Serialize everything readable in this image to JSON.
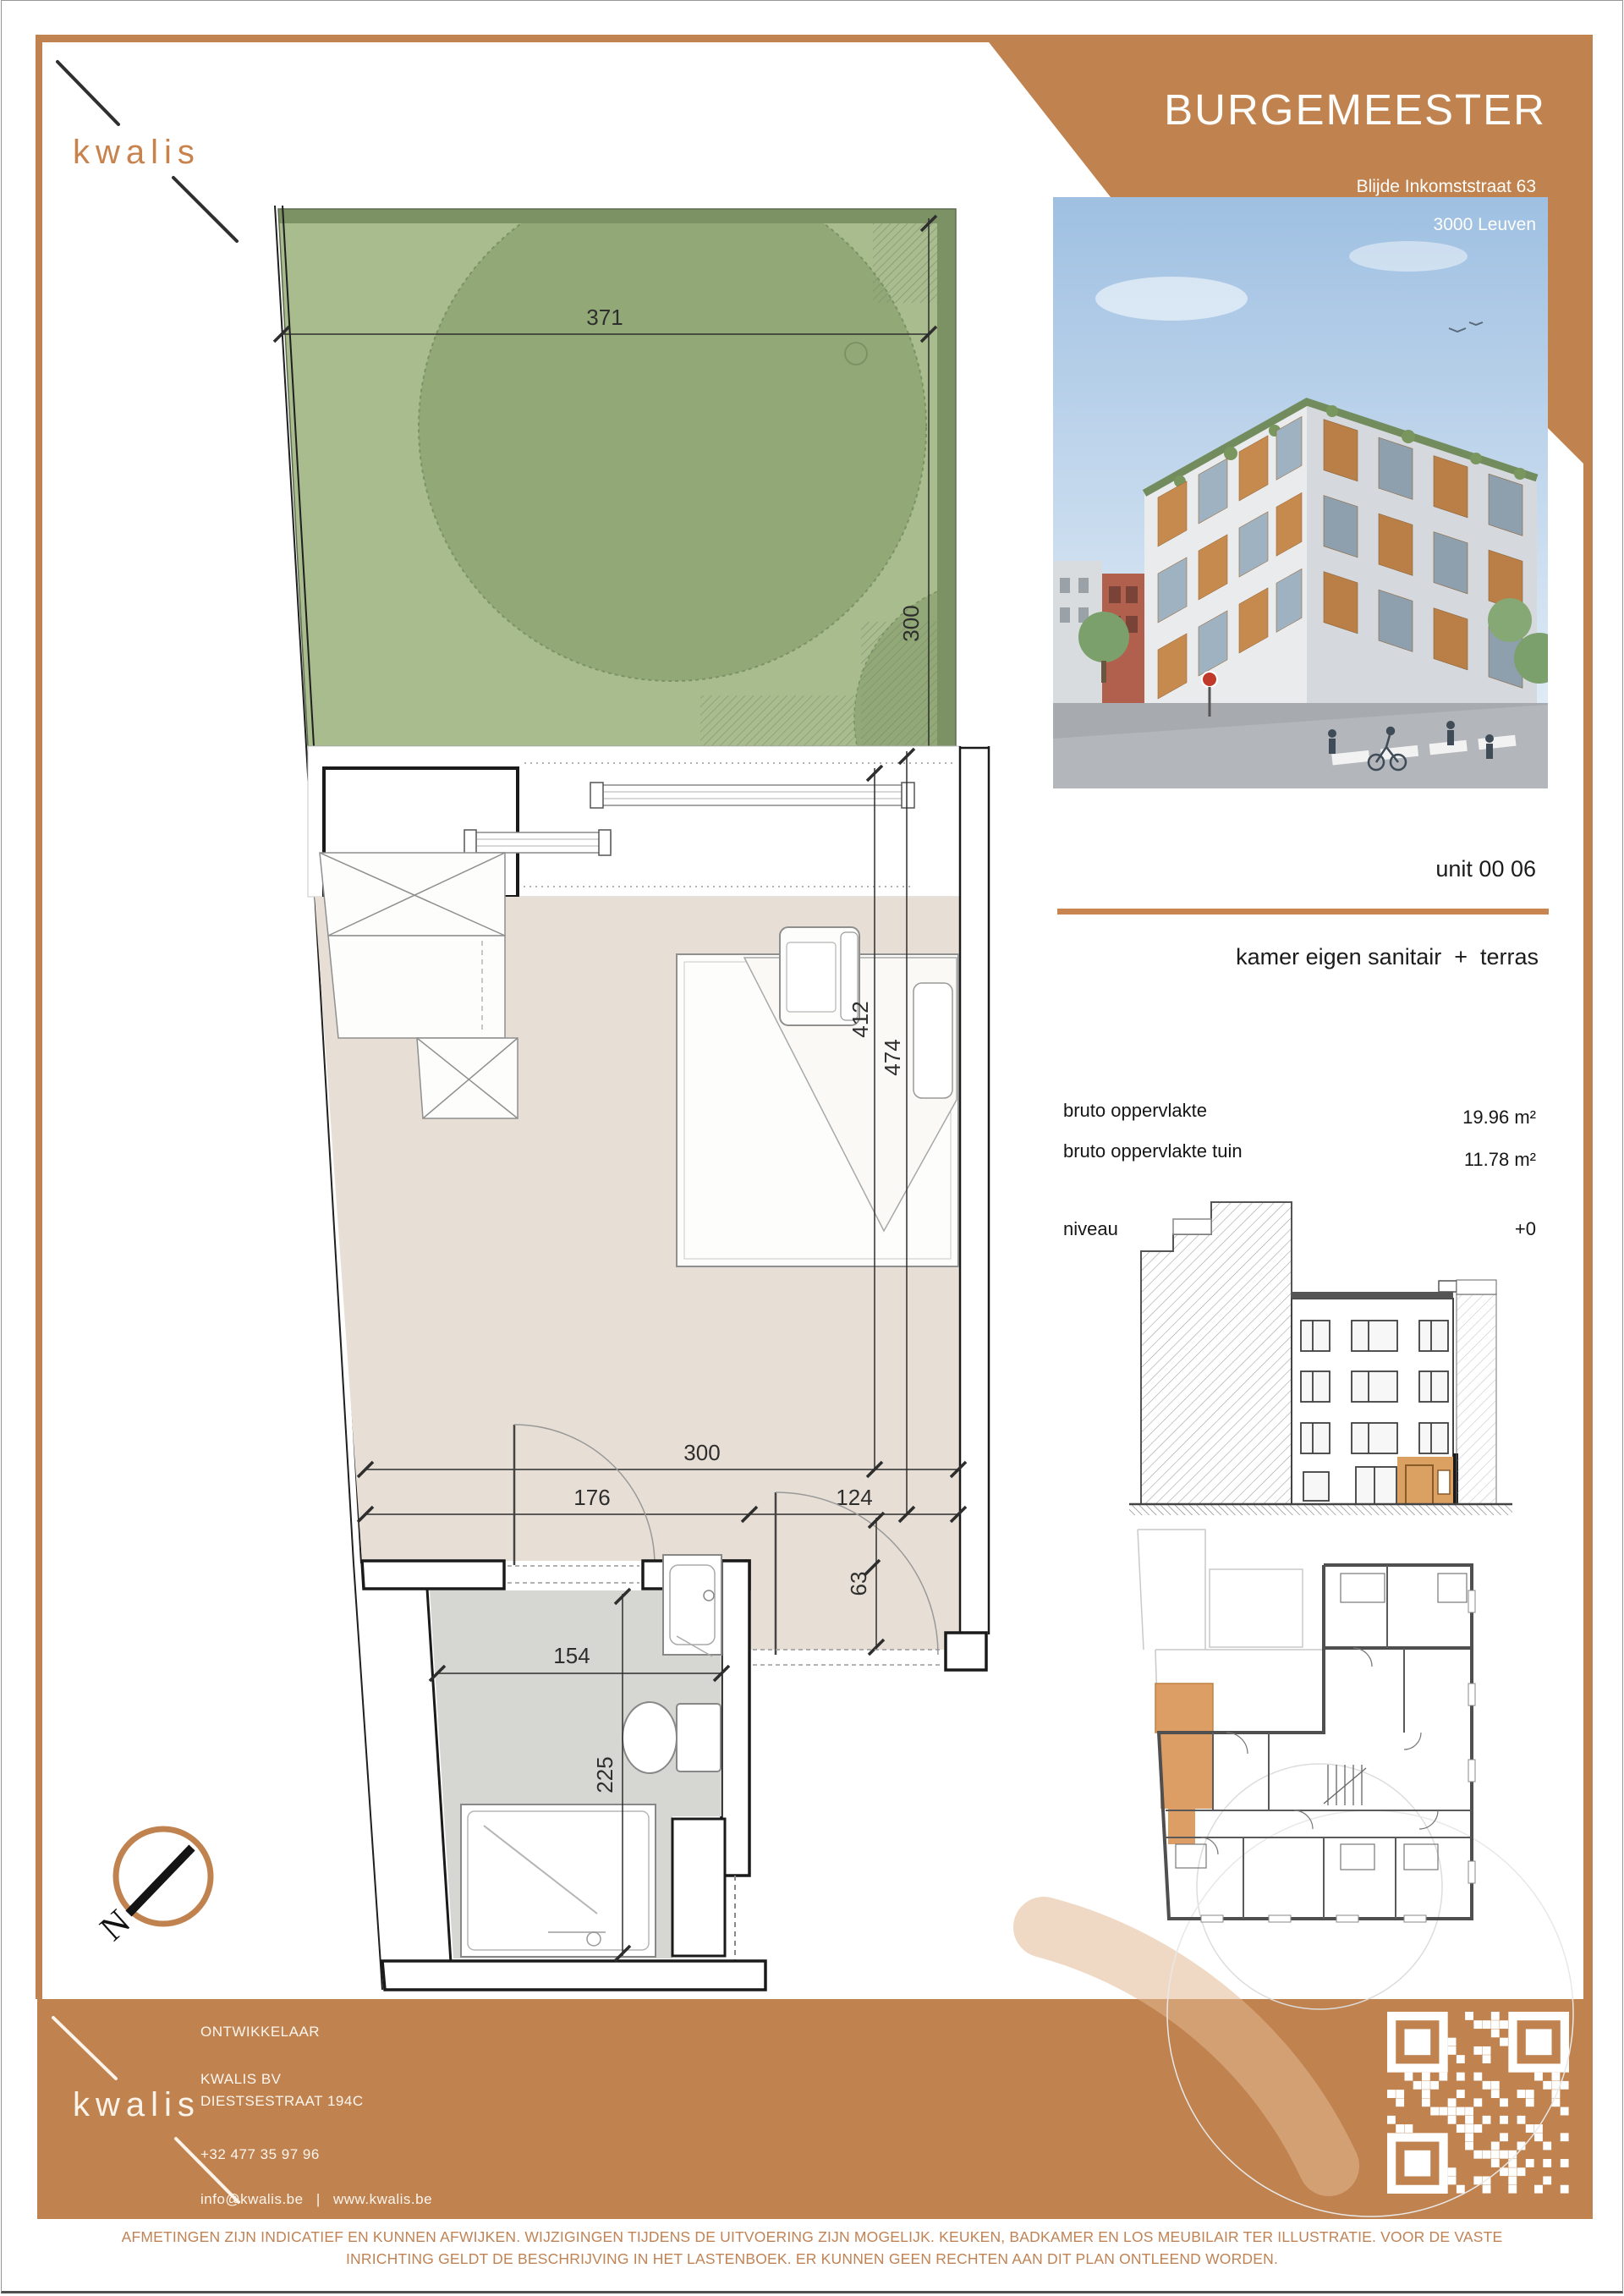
{
  "brand": {
    "name": "kwalis",
    "accent": "#c0824f"
  },
  "header": {
    "project": "BURGEMEESTER",
    "address_line1": "Blijde Inkomststraat 63",
    "address_line2": "3000 Leuven"
  },
  "unit": {
    "number": "unit 00 06",
    "description": "kamer eigen sanitair  +  terras",
    "area_label": "bruto oppervlakte",
    "area_value": "19.96 m²",
    "garden_label": "bruto oppervlakte tuin",
    "garden_value": "11.78 m²",
    "level_label": "niveau",
    "level_value": "+0"
  },
  "plan": {
    "compass": "N",
    "dims": {
      "garden_width": "371",
      "garden_depth": "300",
      "bed_zone": "412",
      "room_depth": "474",
      "room_width": "300",
      "split_left": "176",
      "split_right": "124",
      "entry_depth": "63",
      "bath_width": "154",
      "bath_depth": "225"
    }
  },
  "developer": {
    "heading": "ONTWIKKELAAR",
    "company": "KWALIS BV",
    "street": "DIESTSESTRAAT 194C",
    "phone": "+32 477 35 97 96",
    "email": "info@kwalis.be",
    "separator": "|",
    "website": "www.kwalis.be"
  },
  "disclaimer": {
    "line1": "AFMETINGEN ZIJN INDICATIEF EN KUNNEN AFWIJKEN. WIJZIGINGEN TIJDENS DE UITVOERING ZIJN MOGELIJK. KEUKEN, BADKAMER EN LOS MEUBILAIR TER ILLUSTRATIE. VOOR DE VASTE",
    "line2": "INRICHTING GELDT DE BESCHRIJVING IN HET LASTENBOEK. ER KUNNEN GEEN RECHTEN AAN DIT PLAN ONTLEEND WORDEN."
  }
}
